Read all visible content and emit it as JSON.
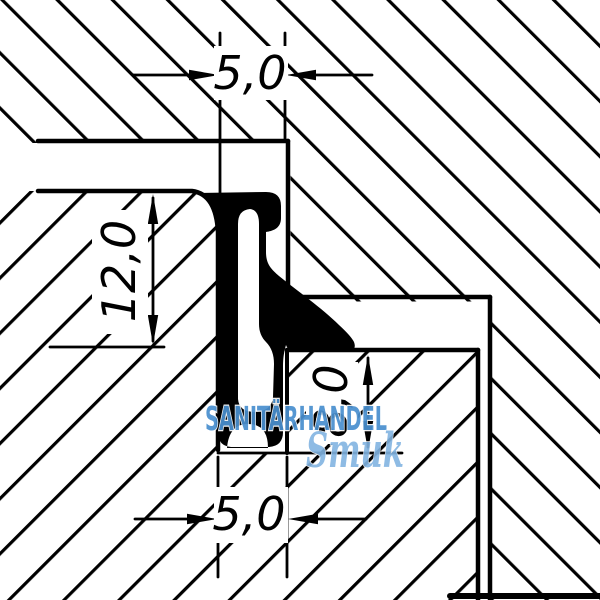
{
  "drawing": {
    "kind": "technical-cross-section-seal-profile",
    "dimensions": {
      "top": "5,0",
      "left": "12,0",
      "middle": "8,0",
      "bottom": "5,0"
    }
  },
  "watermark": {
    "shop": "SANITÄRHANDEL",
    "brand": "Smuk"
  },
  "colors": {
    "line": "#000000",
    "background": "#ffffff",
    "watermark_primary": "#4a90cf",
    "watermark_secondary": "#82b4e2"
  }
}
